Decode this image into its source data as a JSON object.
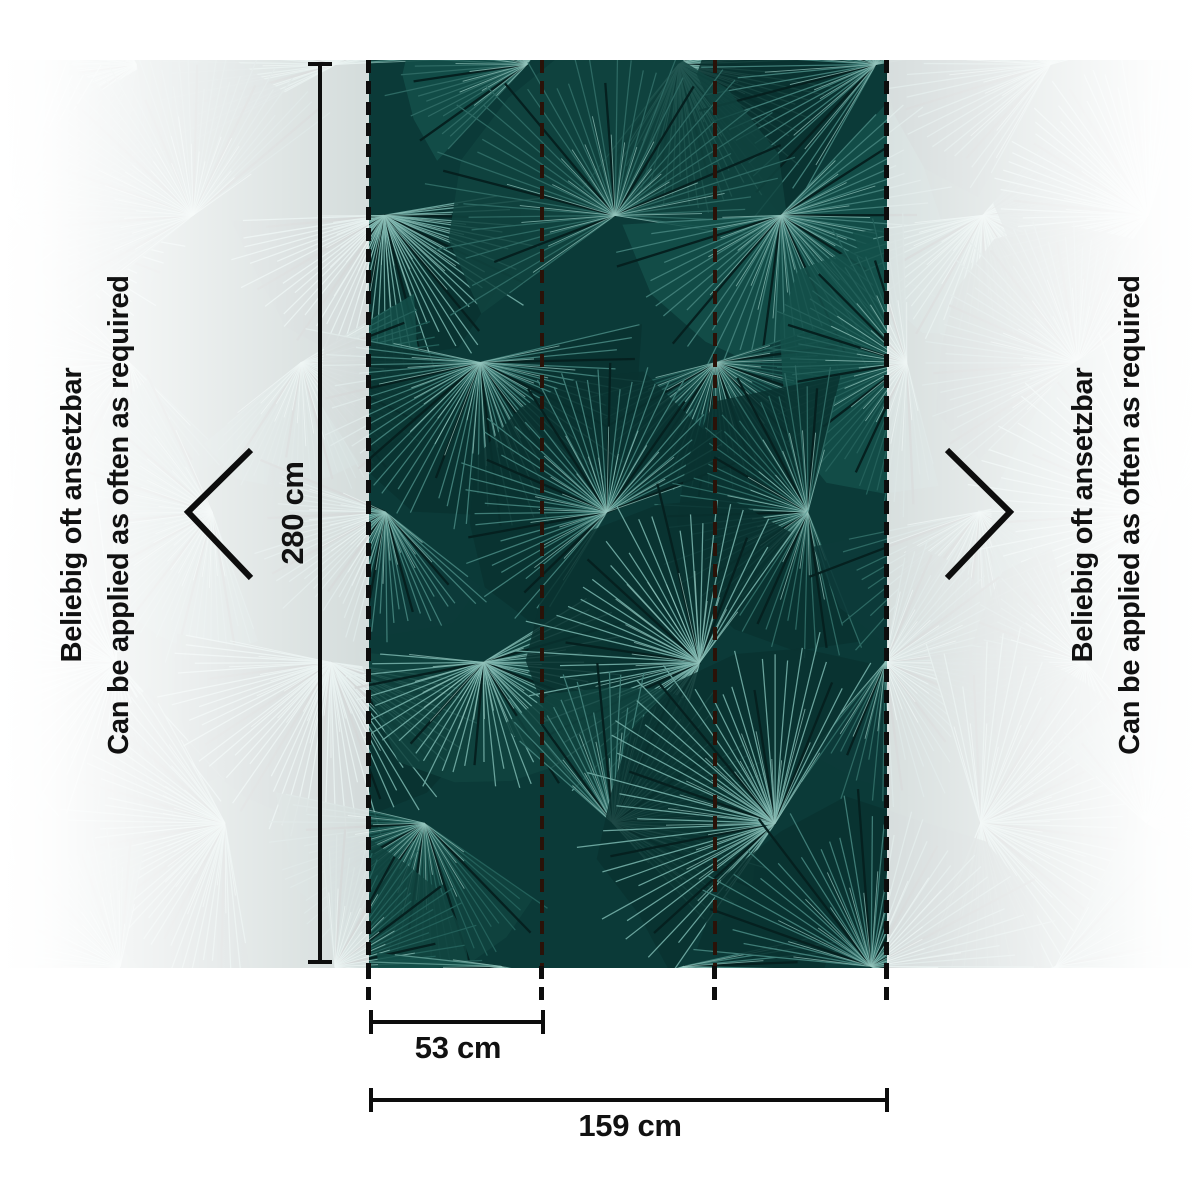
{
  "diagram": {
    "title": "Wallpaper roll application diagram",
    "dimensions": {
      "height_label": "280 cm",
      "strip_width_label": "53 cm",
      "total_width_label": "159 cm"
    },
    "side_note": {
      "line1_de": "Beliebig oft ansetzbar",
      "line2_en": "Can be applied as often as required"
    },
    "colors": {
      "panel_background": "#0b3a38",
      "leaf_shades": [
        "#3f7d77",
        "#2d6963",
        "#559189",
        "#23605a",
        "#6aa49d"
      ],
      "leaf_dark": "#05201f",
      "leaf_bright": "#93c4bc",
      "wedge_shades": [
        "#0d3b39",
        "#114440",
        "#093230",
        "#14504a"
      ],
      "faded_preview_tint": "#d6dfdd",
      "line_color": "#0d0d0d",
      "seam_color": "#2a1208"
    }
  }
}
